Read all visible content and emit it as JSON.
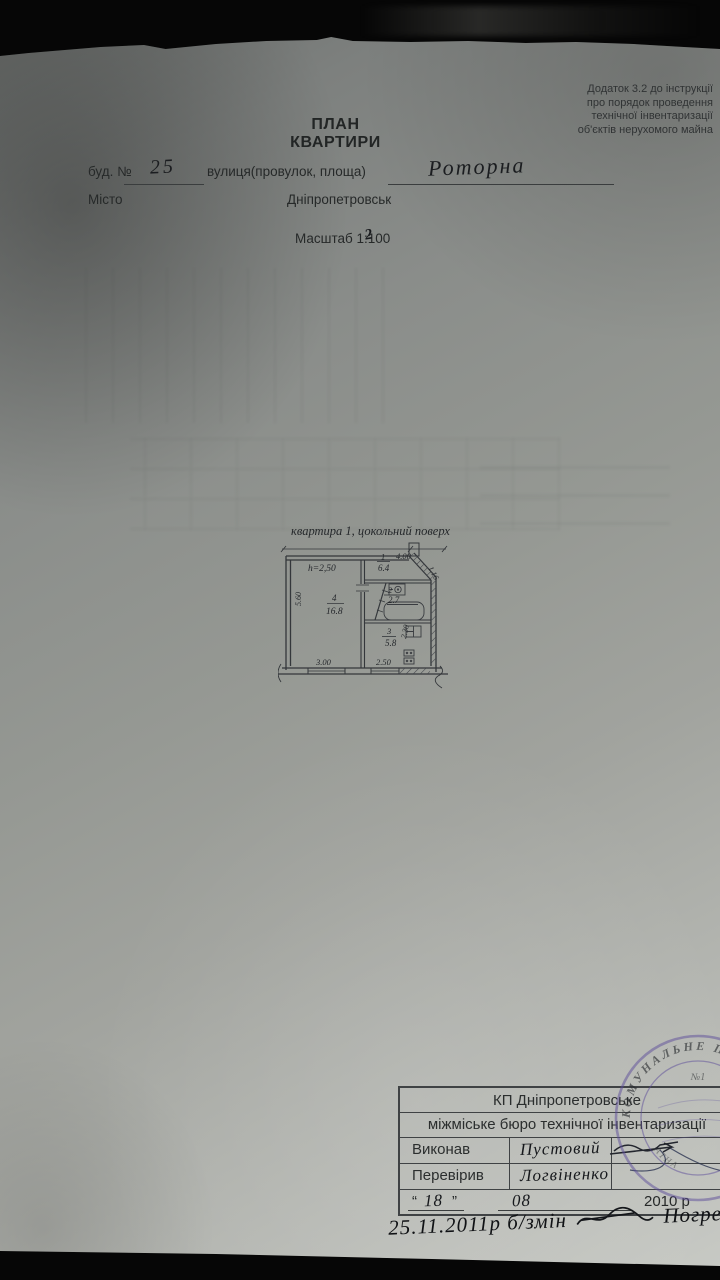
{
  "header_note": {
    "lines": [
      "Додаток 3.2 до інструкції",
      "про порядок проведення",
      "технічної інвентаризації",
      "об'єктів нерухомого майна"
    ]
  },
  "title": {
    "line1": "ПЛАН",
    "line2": "КВАРТИРИ"
  },
  "form": {
    "building_label": "буд. №",
    "building_value": "25",
    "street_label": "вулиця(провулок, площа)",
    "street_value": "Роторна",
    "city_label": "Місто",
    "city_value": "Дніпропетровськ",
    "scale_prefix": "Масштаб 1:",
    "scale_value": "100",
    "scale_overwrite": "2"
  },
  "plan": {
    "caption": "квартира 1,  цокольний поверх",
    "height_label": "h=2,50",
    "rooms": [
      {
        "num": "1",
        "area": "6.4"
      },
      {
        "num": "2",
        "area": "2.7"
      },
      {
        "num": "3",
        "area": "5.8"
      },
      {
        "num": "4",
        "area": "16.8"
      }
    ],
    "dims": {
      "top": "4.00",
      "right_top": "1.16",
      "left": "5.60",
      "bottom_left": "3.00",
      "room3_vertical": "2.30",
      "room3_bottom": "2.50"
    }
  },
  "table": {
    "org1": "КП Дніпропетровське",
    "org2": "міжміське бюро технічної інвентаризації",
    "rows": [
      {
        "label": "Виконав",
        "value": "Пустовий"
      },
      {
        "label": "Перевірив",
        "value": "Логвіненко"
      }
    ],
    "date": {
      "q1": "“",
      "day": "18",
      "q2": "”",
      "month": "08",
      "year": "2010 р"
    }
  },
  "stamp": {
    "arc_text": "КОМУНАЛЬНЕ П",
    "number": "№1",
    "inner_text": "АТНА",
    "color": "#5b4b99"
  },
  "footnote": {
    "text": "25.11.2011р  б/змін",
    "name": "Погреб"
  }
}
